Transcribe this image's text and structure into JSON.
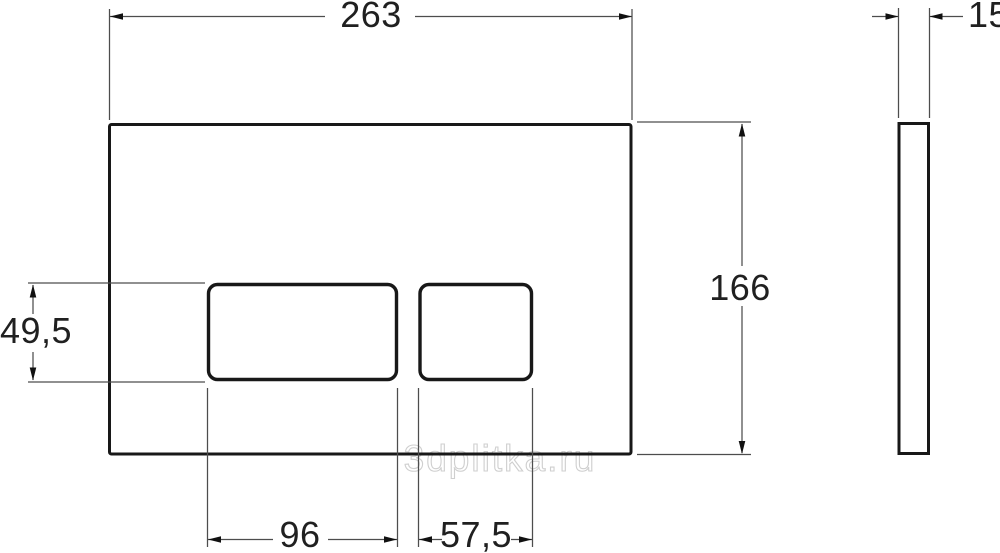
{
  "drawing": {
    "type": "technical-dimension-drawing",
    "front_view": {
      "width_label": "263",
      "height_label": "166",
      "buttons_height_label": "49,5",
      "large_button_width_label": "96",
      "small_button_width_label": "57,5"
    },
    "side_view": {
      "thickness_label": "15"
    },
    "watermark": "3dplitka.ru",
    "colors": {
      "background": "#ffffff",
      "outline": "#181818",
      "dimension_line": "#4d4d4d",
      "label_text": "#202020",
      "watermark": "#cfcfcf"
    }
  }
}
